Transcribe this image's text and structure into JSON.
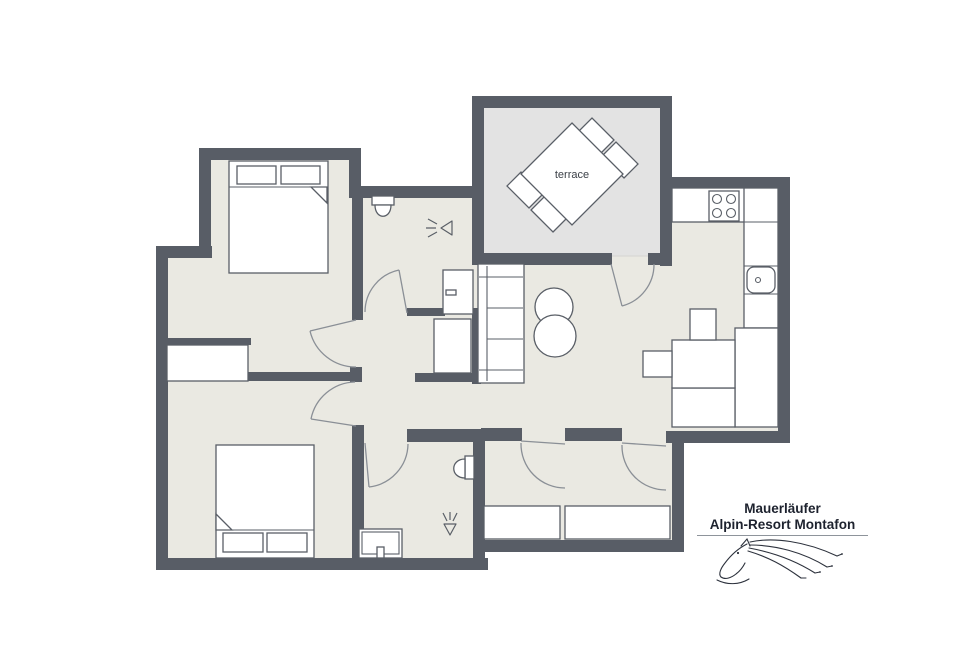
{
  "title": {
    "line1": "Mauerläufer",
    "line2": "Alpin-Resort Montafon"
  },
  "labels": {
    "terrace": "terrace"
  },
  "colors": {
    "wall": "#585d66",
    "floor": "#eae9e2",
    "terrace_floor": "#e3e3e3",
    "outline": "#5a5f67",
    "door": "#8a8f96"
  },
  "plan": {
    "shapes": [
      {
        "t": "poly",
        "name": "apartment-floor",
        "cls": "floor",
        "pts": "205,154 355,154 355,192 478,192 478,102 666,102 666,183 784,183 784,437 678,437 678,546 479,546 479,564 162,564 162,254 205,254"
      },
      {
        "t": "rect",
        "name": "terrace-floor",
        "cls": "tfloor",
        "x": 482,
        "y": 106,
        "w": 180,
        "h": 150
      },
      {
        "t": "rect",
        "name": "wall-bedroom1-top",
        "cls": "wall",
        "x": 199,
        "y": 148,
        "w": 162,
        "h": 12
      },
      {
        "t": "rect",
        "name": "wall-bedroom1-left",
        "cls": "wall",
        "x": 199,
        "y": 148,
        "w": 12,
        "h": 110
      },
      {
        "t": "rect",
        "name": "wall-left-step",
        "cls": "wall",
        "x": 156,
        "y": 246,
        "w": 56,
        "h": 12
      },
      {
        "t": "rect",
        "name": "wall-outer-left",
        "cls": "wall",
        "x": 156,
        "y": 246,
        "w": 12,
        "h": 324
      },
      {
        "t": "rect",
        "name": "wall-outer-bottom-left",
        "cls": "wall",
        "x": 156,
        "y": 558,
        "w": 332,
        "h": 12
      },
      {
        "t": "rect",
        "name": "wall-bedroom1-right-upper",
        "cls": "wall",
        "x": 349,
        "y": 148,
        "w": 12,
        "h": 50
      },
      {
        "t": "rect",
        "name": "wall-bathroom1-top",
        "cls": "wall",
        "x": 349,
        "y": 186,
        "w": 130,
        "h": 12
      },
      {
        "t": "rect",
        "name": "wall-terrace-left",
        "cls": "wall",
        "x": 472,
        "y": 96,
        "w": 12,
        "h": 168
      },
      {
        "t": "rect",
        "name": "wall-terrace-top",
        "cls": "wall",
        "x": 472,
        "y": 96,
        "w": 200,
        "h": 12
      },
      {
        "t": "rect",
        "name": "wall-terrace-right",
        "cls": "wall",
        "x": 660,
        "y": 96,
        "w": 12,
        "h": 170
      },
      {
        "t": "rect",
        "name": "wall-kitchen-top",
        "cls": "wall",
        "x": 660,
        "y": 177,
        "w": 130,
        "h": 12
      },
      {
        "t": "rect",
        "name": "wall-kitchen-right",
        "cls": "wall",
        "x": 778,
        "y": 177,
        "w": 12,
        "h": 266
      },
      {
        "t": "rect",
        "name": "wall-kitchen-bottom",
        "cls": "wall",
        "x": 666,
        "y": 431,
        "w": 124,
        "h": 12
      },
      {
        "t": "rect",
        "name": "wall-hall-right",
        "cls": "wall",
        "x": 672,
        "y": 431,
        "w": 12,
        "h": 121
      },
      {
        "t": "rect",
        "name": "wall-hall-bottom",
        "cls": "wall",
        "x": 473,
        "y": 540,
        "w": 211,
        "h": 12
      },
      {
        "t": "rect",
        "name": "wall-bathroom2-right",
        "cls": "wall",
        "x": 473,
        "y": 429,
        "w": 12,
        "h": 141
      },
      {
        "t": "rect",
        "name": "wall-bedroom1-bathroom1-divider",
        "cls": "wall",
        "x": 352,
        "y": 194,
        "w": 11,
        "h": 126
      },
      {
        "t": "rect",
        "name": "wall-bathroom1-south",
        "cls": "wall",
        "x": 407,
        "y": 308,
        "w": 38,
        "h": 8
      },
      {
        "t": "rect",
        "name": "wall-niche-right",
        "cls": "wall",
        "x": 472,
        "y": 308,
        "w": 9,
        "h": 76
      },
      {
        "t": "rect",
        "name": "wall-niche-bottom",
        "cls": "wall",
        "x": 415,
        "y": 373,
        "w": 60,
        "h": 9
      },
      {
        "t": "rect",
        "name": "wall-corridor",
        "cls": "wall",
        "x": 248,
        "y": 372,
        "w": 106,
        "h": 9
      },
      {
        "t": "rect",
        "name": "wall-corridor-post",
        "cls": "wall",
        "x": 350,
        "y": 367,
        "w": 12,
        "h": 15
      },
      {
        "t": "rect",
        "name": "wall-bedroom1-closet",
        "cls": "wall",
        "x": 163,
        "y": 338,
        "w": 88,
        "h": 7
      },
      {
        "t": "rect",
        "name": "wall-bedroom2-bathroom2-divider",
        "cls": "wall",
        "x": 352,
        "y": 425,
        "w": 12,
        "h": 133
      },
      {
        "t": "rect",
        "name": "wall-bathroom2-top",
        "cls": "wall",
        "x": 407,
        "y": 429,
        "w": 76,
        "h": 13
      },
      {
        "t": "rect",
        "name": "wall-hall-top-a",
        "cls": "wall",
        "x": 481,
        "y": 428,
        "w": 41,
        "h": 13
      },
      {
        "t": "rect",
        "name": "wall-hall-top-b",
        "cls": "wall",
        "x": 565,
        "y": 428,
        "w": 57,
        "h": 13
      },
      {
        "t": "rect",
        "name": "wall-terrace-bottom-stub",
        "cls": "wall",
        "x": 648,
        "y": 253,
        "w": 24,
        "h": 12
      },
      {
        "t": "rect",
        "name": "wall-terrace-bottom",
        "cls": "wall",
        "x": 472,
        "y": 253,
        "w": 140,
        "h": 12
      },
      {
        "t": "poly",
        "name": "terrace-chair",
        "cls": "furn",
        "pts": "600,154 614,140 592,118 578,132"
      },
      {
        "t": "poly",
        "name": "terrace-chair",
        "cls": "furn",
        "pts": "624,178 638,164 616,142 602,156"
      },
      {
        "t": "poly",
        "name": "terrace-chair",
        "cls": "furn",
        "pts": "529,208 543,194 521,172 507,186"
      },
      {
        "t": "poly",
        "name": "terrace-chair",
        "cls": "furn",
        "pts": "553,232 567,218 545,196 531,210"
      },
      {
        "t": "poly",
        "name": "terrace-table",
        "cls": "furn",
        "pts": "572,123 623,174 572,225 521,174"
      },
      {
        "t": "rect",
        "name": "bed-bedroom1",
        "cls": "furn",
        "x": 229,
        "y": 161,
        "w": 99,
        "h": 112
      },
      {
        "t": "line",
        "name": "bed-sheet-line",
        "cls": "thin",
        "x1": 229,
        "y1": 187,
        "x2": 328,
        "y2": 187
      },
      {
        "t": "poly",
        "name": "bed-fold",
        "cls": "furn",
        "pts": "311,187 327,187 327,203"
      },
      {
        "t": "rect",
        "name": "pillow",
        "cls": "furn",
        "x": 237,
        "y": 166,
        "w": 39,
        "h": 18
      },
      {
        "t": "rect",
        "name": "pillow",
        "cls": "furn",
        "x": 281,
        "y": 166,
        "w": 39,
        "h": 18
      },
      {
        "t": "rect",
        "name": "bed-bedroom2",
        "cls": "furn",
        "x": 216,
        "y": 445,
        "w": 98,
        "h": 113
      },
      {
        "t": "line",
        "name": "bed-sheet-line",
        "cls": "thin",
        "x1": 216,
        "y1": 530,
        "x2": 314,
        "y2": 530
      },
      {
        "t": "poly",
        "name": "bed-fold",
        "cls": "furn",
        "pts": "216,514 232,530 216,530"
      },
      {
        "t": "rect",
        "name": "pillow",
        "cls": "furn",
        "x": 223,
        "y": 533,
        "w": 40,
        "h": 19
      },
      {
        "t": "rect",
        "name": "pillow",
        "cls": "furn",
        "x": 267,
        "y": 533,
        "w": 40,
        "h": 19
      },
      {
        "t": "rect",
        "name": "wardrobe-bedroom2",
        "cls": "furn",
        "x": 167,
        "y": 345,
        "w": 81,
        "h": 36
      },
      {
        "t": "rect",
        "name": "niche-wardrobe",
        "cls": "furn",
        "x": 434,
        "y": 319,
        "w": 37,
        "h": 54
      },
      {
        "t": "rect",
        "name": "shower-cabinet",
        "cls": "furn",
        "x": 443,
        "y": 270,
        "w": 30,
        "h": 44
      },
      {
        "t": "rect",
        "name": "cabinet-handle",
        "cls": "furn",
        "x": 446,
        "y": 290,
        "w": 10,
        "h": 5
      },
      {
        "t": "rect",
        "name": "sofa",
        "cls": "furn",
        "x": 478,
        "y": 264,
        "w": 46,
        "h": 119
      },
      {
        "t": "line",
        "name": "sofa-back-line",
        "cls": "thin",
        "x1": 487,
        "y1": 266,
        "x2": 487,
        "y2": 381
      },
      {
        "t": "line",
        "name": "sofa-armrest-line",
        "cls": "thin",
        "x1": 479,
        "y1": 277,
        "x2": 523,
        "y2": 277
      },
      {
        "t": "line",
        "name": "sofa-armrest-line",
        "cls": "thin",
        "x1": 479,
        "y1": 370,
        "x2": 523,
        "y2": 370
      },
      {
        "t": "line",
        "name": "sofa-seat-line",
        "cls": "thin",
        "x1": 487,
        "y1": 308,
        "x2": 523,
        "y2": 308
      },
      {
        "t": "line",
        "name": "sofa-seat-line",
        "cls": "thin",
        "x1": 487,
        "y1": 339,
        "x2": 523,
        "y2": 339
      },
      {
        "t": "circle",
        "name": "coffee-table",
        "cls": "furn",
        "cx": 554,
        "cy": 307,
        "r": 19
      },
      {
        "t": "circle",
        "name": "coffee-table",
        "cls": "furn",
        "cx": 555,
        "cy": 336,
        "r": 21
      },
      {
        "t": "rect",
        "name": "kitchen-counter-top",
        "cls": "furn",
        "x": 672,
        "y": 188,
        "w": 106,
        "h": 34
      },
      {
        "t": "rect",
        "name": "stove",
        "cls": "furn",
        "x": 709,
        "y": 191,
        "w": 30,
        "h": 30
      },
      {
        "t": "circle",
        "name": "stove-burner",
        "cls": "thin",
        "cx": 717,
        "cy": 199,
        "r": 4.5
      },
      {
        "t": "circle",
        "name": "stove-burner",
        "cls": "thin",
        "cx": 731,
        "cy": 199,
        "r": 4.5
      },
      {
        "t": "circle",
        "name": "stove-burner",
        "cls": "thin",
        "cx": 717,
        "cy": 213,
        "r": 4.5
      },
      {
        "t": "circle",
        "name": "stove-burner",
        "cls": "thin",
        "cx": 731,
        "cy": 213,
        "r": 4.5
      },
      {
        "t": "rect",
        "name": "kitchen-counter-right",
        "cls": "furn",
        "x": 744,
        "y": 188,
        "w": 34,
        "h": 140
      },
      {
        "t": "line",
        "name": "counter-division",
        "cls": "thin",
        "x1": 744,
        "y1": 222,
        "x2": 778,
        "y2": 222
      },
      {
        "t": "line",
        "name": "counter-division",
        "cls": "thin",
        "x1": 744,
        "y1": 266,
        "x2": 778,
        "y2": 266
      },
      {
        "t": "line",
        "name": "counter-division",
        "cls": "thin",
        "x1": 744,
        "y1": 294,
        "x2": 778,
        "y2": 294
      },
      {
        "t": "rect",
        "name": "kitchen-sink",
        "cls": "furn",
        "x": 747,
        "y": 267,
        "w": 28,
        "h": 26,
        "rx": 7
      },
      {
        "t": "circle",
        "name": "sink-drain",
        "cls": "thin",
        "cx": 758,
        "cy": 280,
        "r": 2.5
      },
      {
        "t": "rect",
        "name": "kitchen-counter-wide",
        "cls": "furn",
        "x": 735,
        "y": 328,
        "w": 43,
        "h": 99
      },
      {
        "t": "rect",
        "name": "kitchen-counter-bottom",
        "cls": "furn",
        "x": 672,
        "y": 388,
        "w": 63,
        "h": 39
      },
      {
        "t": "rect",
        "name": "kitchen-table",
        "cls": "furn",
        "x": 672,
        "y": 340,
        "w": 63,
        "h": 48
      },
      {
        "t": "rect",
        "name": "kitchen-chair",
        "cls": "furn",
        "x": 690,
        "y": 309,
        "w": 26,
        "h": 31
      },
      {
        "t": "rect",
        "name": "kitchen-chair",
        "cls": "furn",
        "x": 643,
        "y": 351,
        "w": 29,
        "h": 26
      },
      {
        "t": "rect",
        "name": "hall-closet",
        "cls": "furn",
        "x": 484,
        "y": 506,
        "w": 76,
        "h": 33
      },
      {
        "t": "rect",
        "name": "hall-closet",
        "cls": "furn",
        "x": 565,
        "y": 506,
        "w": 105,
        "h": 33
      },
      {
        "t": "rect",
        "name": "vanity-bathroom2",
        "cls": "furn",
        "x": 359,
        "y": 529,
        "w": 43,
        "h": 29
      },
      {
        "t": "rect",
        "name": "vanity-inner-line",
        "cls": "thin",
        "x": 362,
        "y": 532,
        "w": 37,
        "h": 22
      },
      {
        "t": "rect",
        "name": "vanity-faucet",
        "cls": "furn",
        "x": 377,
        "y": 547,
        "w": 7,
        "h": 11
      },
      {
        "t": "rect",
        "name": "toilet-tank",
        "cls": "furn",
        "x": 372,
        "y": 196,
        "w": 22,
        "h": 9
      },
      {
        "t": "path",
        "name": "toilet-bowl",
        "cls": "furn",
        "d": "M375,205 C375,220 391,220 391,205 Z"
      },
      {
        "t": "rect",
        "name": "toilet-tank",
        "cls": "furn",
        "x": 465,
        "y": 456,
        "w": 9,
        "h": 23
      },
      {
        "t": "path",
        "name": "toilet-bowl",
        "cls": "furn",
        "d": "M465,459 C450,459 450,478 465,478 Z"
      },
      {
        "t": "path",
        "name": "shower-icon",
        "cls": "icon",
        "d": "M452,221 L452,235 L441,228 Z M437,224 L428,219 M436,228 L426,228 M437,232 L428,237"
      },
      {
        "t": "path",
        "name": "shower-icon",
        "cls": "icon",
        "d": "M444,524 L456,524 L450,535 Z M447,521 L443,513 M450,520 L450,512 M453,521 L457,513"
      },
      {
        "t": "path",
        "name": "door-bedroom1",
        "cls": "door",
        "d": "M356,320 L310,331 M310,331 A47,47 0 0 0 356,367"
      },
      {
        "t": "path",
        "name": "door-bedroom2",
        "cls": "door",
        "d": "M356,426 L311,419 M311,419 A46,46 0 0 1 355,382"
      },
      {
        "t": "path",
        "name": "door-bathroom1",
        "cls": "door",
        "d": "M407,313 L399,270 M365,312 A43,43 0 0 1 399,270"
      },
      {
        "t": "path",
        "name": "door-terrace",
        "cls": "door",
        "d": "M611,264 L622,306 M622,306 A43,43 0 0 0 654,264"
      },
      {
        "t": "path",
        "name": "door-hall-living",
        "cls": "door",
        "d": "M565,444 L521,441 M521,443 A44,44 0 0 0 565,488"
      },
      {
        "t": "path",
        "name": "door-hall-kitchen",
        "cls": "door",
        "d": "M666,446 L622,443 M622,445 A44,44 0 0 0 666,490"
      },
      {
        "t": "path",
        "name": "door-bathroom2",
        "cls": "door",
        "d": "M365,443 L369,487 M369,487 A44,44 0 0 0 408,444"
      },
      {
        "t": "text",
        "name": "terrace-label",
        "cls": "plan-label",
        "x": 572,
        "y": 178,
        "bind": "labels.terrace"
      }
    ]
  }
}
